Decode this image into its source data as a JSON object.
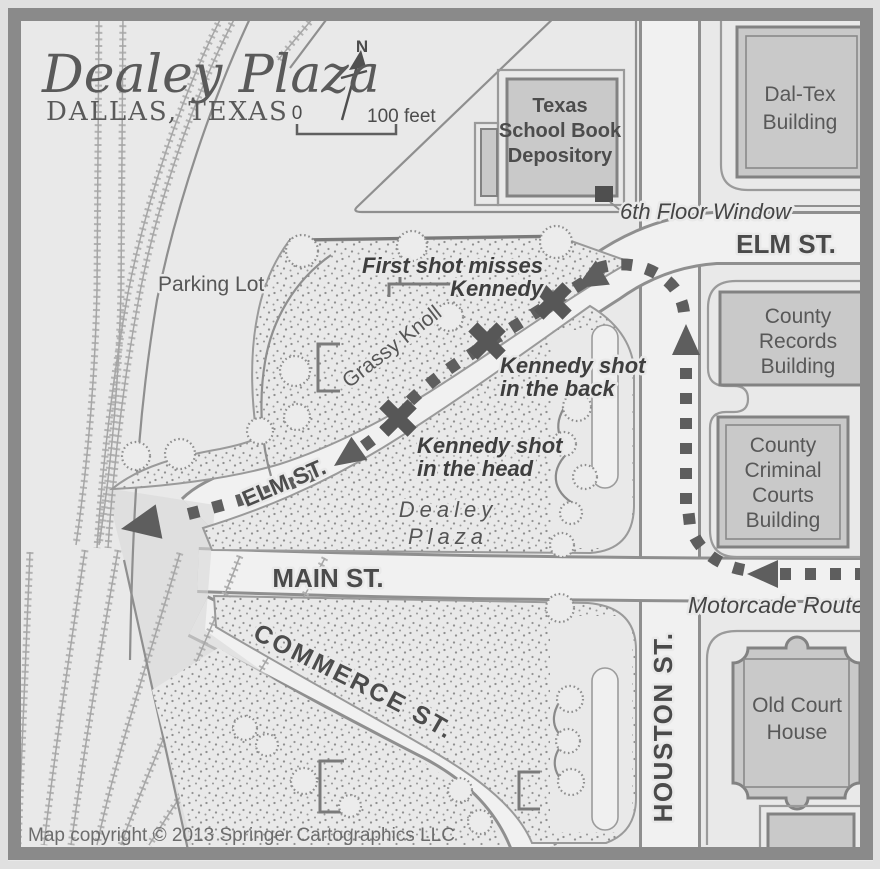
{
  "map": {
    "title": "Dealey Plaza",
    "subtitle": "DALLAS, TEXAS",
    "compass": {
      "north_label": "N"
    },
    "scale": {
      "zero": "0",
      "distance": "100 feet"
    },
    "copyright": "Map copyright © 2013 Springer Cartographics LLC",
    "colors": {
      "background": "#e9e9e9",
      "frame": "#8a8a8a",
      "building_fill": "#c9c9c9",
      "route": "#5e5e5e",
      "label_dark": "#3e3e3e"
    },
    "streets": {
      "elm_east": "ELM ST.",
      "elm_curve": "ELM ST.",
      "main": "MAIN ST.",
      "commerce": "COMMERCE ST.",
      "houston": "HOUSTON ST."
    },
    "areas": {
      "parking": "Parking Lot",
      "knoll": "Grassy Knoll",
      "plaza": [
        "Dealey",
        "Plaza"
      ]
    },
    "buildings": {
      "depository": [
        "Texas",
        "School Book",
        "Depository"
      ],
      "daltex": [
        "Dal-Tex",
        "Building"
      ],
      "county_records": [
        "County",
        "Records",
        "Building"
      ],
      "county_courts": [
        "County",
        "Criminal",
        "Courts",
        "Building"
      ],
      "old_courthouse": [
        "Old Court",
        "House"
      ]
    },
    "annotations": {
      "window": "6th Floor Window",
      "first_shot": [
        "First shot misses",
        "Kennedy"
      ],
      "back_shot": [
        "Kennedy shot",
        "in the back"
      ],
      "head_shot": [
        "Kennedy shot",
        "in the head"
      ],
      "route": "Motorcade Route"
    }
  }
}
